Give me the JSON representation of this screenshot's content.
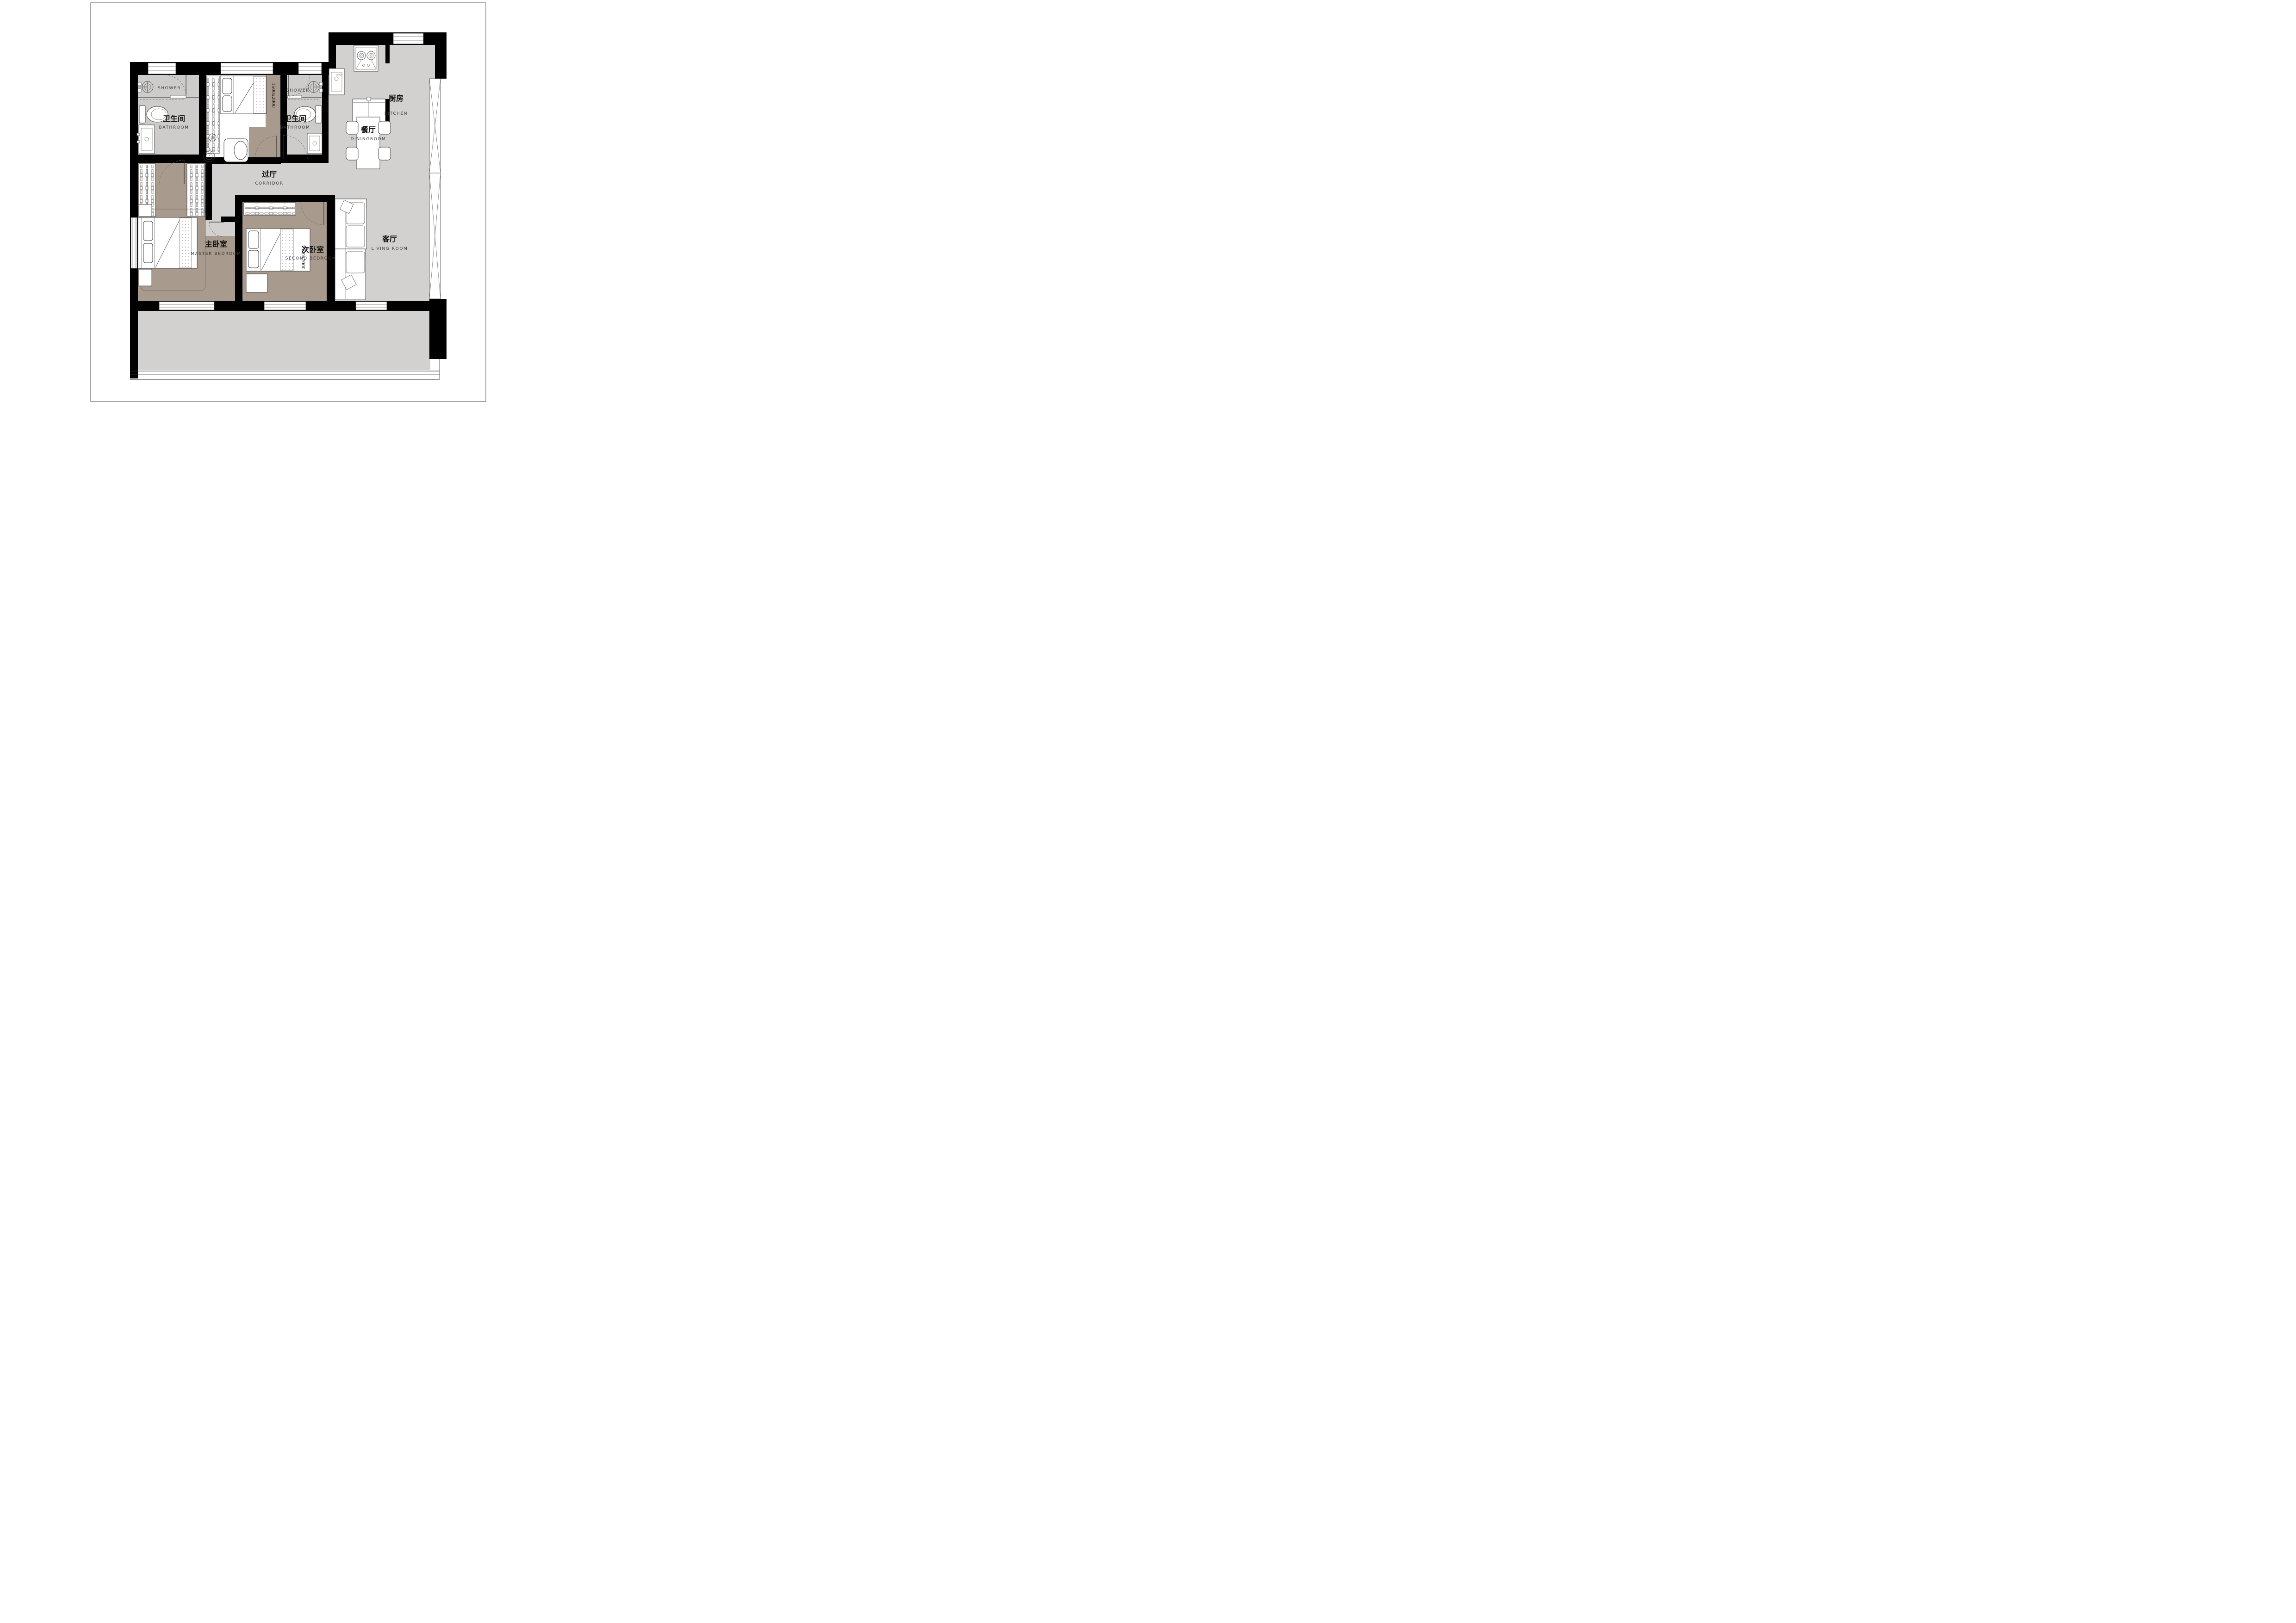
{
  "page": {
    "background": "#ffffff",
    "border_color": "#4f4f4f"
  },
  "colors": {
    "wall": "#000000",
    "floor_main": "#d2d1cf",
    "floor_bath": "#cdccca",
    "floor_bedroom": "#a89a8c",
    "floor_balcony": "#d2d1cf",
    "line": "#2f2f2f"
  },
  "rooms": {
    "kitchen": {
      "name_zh": "厨房",
      "name_en": "KITCHEN"
    },
    "dining": {
      "name_zh": "餐厅",
      "name_en": "DININGROOM"
    },
    "corridor": {
      "name_zh": "过厅",
      "name_en": "CORRIDOR"
    },
    "living": {
      "name_zh": "客厅",
      "name_en": "LIVING ROOM"
    },
    "bathroom_left": {
      "name_zh": "卫生间",
      "name_en": "BATHROOM",
      "zone_label": "SHOWER"
    },
    "bathroom_right": {
      "name_zh": "卫生间",
      "name_en": "BATHROOM",
      "zone_label": "SHOWER"
    },
    "master_bedroom": {
      "name_zh": "主卧室",
      "name_en": "MASTER BEDROOM"
    },
    "second_bedroom": {
      "name_zh": "次卧室",
      "name_en": "SECOND BEDROOM",
      "bed_size": "1500x2000"
    },
    "north_bedroom": {
      "bed_size": "1500x2000"
    }
  }
}
